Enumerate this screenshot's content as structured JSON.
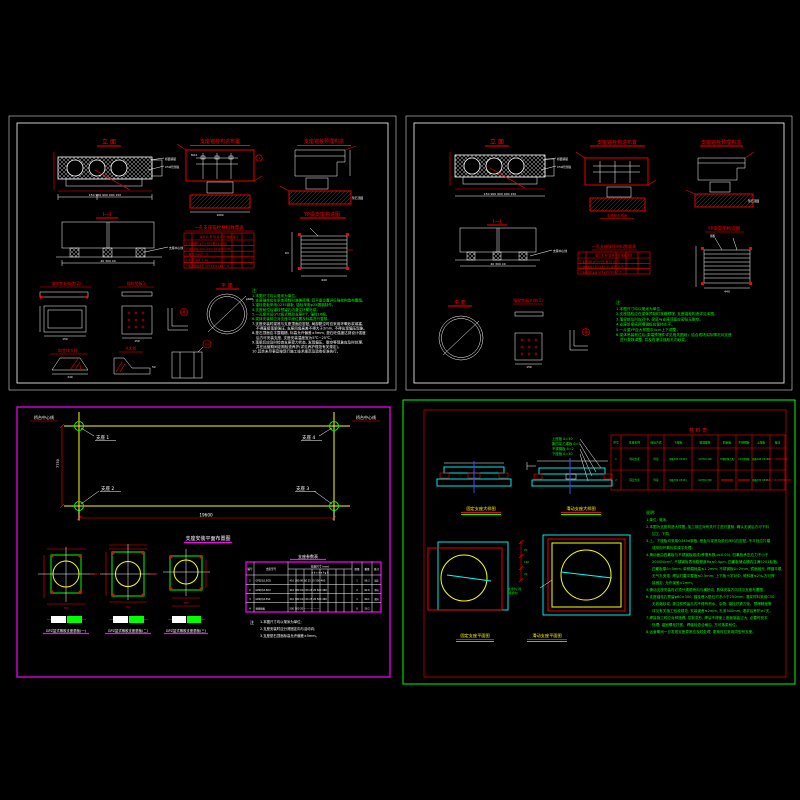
{
  "colors": {
    "background": "#000000",
    "line_white": "#ffffff",
    "line_red": "#ff0000",
    "line_green": "#00ff00",
    "line_yellow": "#ffff00",
    "line_cyan": "#00ffff",
    "line_magenta": "#ff00ff",
    "line_blue": "#4444ff"
  },
  "panel1": {
    "title_elevation": "立 面",
    "title_section": "Ⅰ—Ⅰ",
    "title_anchor_left": "支座锚栓构造布置",
    "title_anchor_right": "支座锚栓预埋构造",
    "title_yp": "YP梁支座构造图",
    "title_plan": "平 面",
    "title_pad2": "锚栓垫板构造(2)",
    "title_pad1": "锚栓垫板1",
    "title_wedge": "斜垫块大样",
    "title_detail_a": "A大样",
    "label_deck": "桥面铺装",
    "label_c50": "C50砼封锚",
    "label_center": "支座中心线",
    "label_m24": "M24",
    "label_phi600": "φ600",
    "label_phi60": "60",
    "label_mark1": "1",
    "dims": {
      "elevation": "150 900 900 900 150",
      "section": "40 300 40",
      "yp_w": "440",
      "yp_h": "63",
      "pad2": "150",
      "pad1": "150",
      "wedge": "240",
      "detail_a": "50",
      "anchor_base": "1000",
      "pedestal_top": "垫石顶面"
    },
    "table": {
      "title": "一孔支座锚栓材料数量表",
      "headers": [
        "编号",
        "名 称",
        "规 格",
        "单位",
        "数量",
        "备注"
      ],
      "rows": [
        [
          "1",
          "支座锚栓",
          "φ25×400",
          "根",
          "16",
          "Q235"
        ],
        [
          "2",
          "锚栓垫板",
          "150×150×10",
          "块",
          "8",
          "Q235"
        ],
        [
          "3",
          "螺 母",
          "M24",
          "个",
          "32",
          ""
        ],
        [
          "4",
          "垫 圈",
          "φ25",
          "个",
          "16",
          ""
        ],
        [
          "5",
          "板式橡胶支座",
          "GYZ φ250×63",
          "个",
          "8",
          ""
        ]
      ]
    },
    "notes_label": "注:",
    "notes_green": [
      "1.本图尺寸均以毫米为单位。",
      "2.支座锚栓应在梁体预制时准确预埋, 其平面位置详见锚栓构造布置图。",
      "3.锚栓垫板采用Q235钢板, 锚栓采用φ25圆钢制作。",
      "4.支座就位后锚栓预留孔内灌注环氧砂浆。",
      "5.一孔梁共设GYZ板式橡胶支座8个, 锚栓16根。",
      "6.梁体安装前应对支座平面位置及标高进行复核。"
    ],
    "notes_white": [
      "7.支座安装时梁底与支座顶面应密贴, 局部脱空时应采用环氧砂浆填塞,",
      "不得直接落梁强压, 支座四角高差不得大于2mm, 不得出现偏压现象。",
      "8.垫石顶面应平整粗糙, 标高允许偏差±5mm, 垫石砼强度达到设计强度",
      "后方可安装支座, 支座安装温度宜为5℃~25℃。",
      "9.落梁后应及时检查支座受力状态, 发现偏压、脱空等现象应及时处理,",
      "并在运营期间定期检查养护(详见养护规范有关规定)。",
      "10.其余未尽事宜按现行施工技术规范及验收标准执行。"
    ]
  },
  "panel2": {
    "title_elevation": "立 面",
    "title_section": "Ⅰ—Ⅰ",
    "title_anchor_left": "支座锚栓构造布置",
    "title_anchor_right": "支座锚栓预埋构造",
    "title_pedestal": "支座垫石构造",
    "title_yp": "YP梁支座构造图",
    "title_plan": "平 面",
    "title_pad1": "锚栓垫板大样(1)",
    "label_deck": "桥面铺装",
    "label_c50": "C50砼封锚",
    "label_center": "支座中心线",
    "label_pedestal_top": "垫石顶面",
    "label_steel": "钢板",
    "dims": {
      "elevation": "150 900 900 900 150",
      "section": "40 300 40",
      "yp_w": "440",
      "pad1": "150"
    },
    "table": {
      "title": "一孔支座锚栓材料数量表",
      "headers": [
        "编号",
        "名 称",
        "规 格",
        "单位",
        "数量",
        "备注"
      ],
      "rows": [
        [
          "1",
          "支座锚栓",
          "φ25×400",
          "根",
          "16",
          "Q235"
        ],
        [
          "2",
          "锚栓垫板",
          "150×150×10",
          "块",
          "8",
          "Q235"
        ],
        [
          "3",
          "板式橡胶支座",
          "GYZ φ250×63",
          "个",
          "8",
          ""
        ]
      ]
    },
    "notes_label": "注:",
    "notes_green": [
      "1.本图尺寸均以毫米为单位。",
      "2.支座锚栓应在梁体预制时准确预埋, 支座锚栓构造详见本图。",
      "3.落梁就位时应对中, 梁底与支座顶面应密贴无脱空。",
      "4.支座处梁底预埋钢板应保持水平。",
      "5.一片梁YP自大样图中4cm上下调整。",
      "6.梁体吊装就位后(梁端预埋件详见相关图纸), 结合现场实际情况对支座",
      "进行复核调整, 并及时灌注锚栓孔内砂浆。"
    ]
  },
  "panel3": {
    "label_top_left": "桥台中心线",
    "label_top_right": "桥台中心线",
    "bearing_labels": [
      "支座 1",
      "支座 2",
      "支座 3",
      "支座 4"
    ],
    "dim_span": "19600",
    "dim_width": "7750",
    "title": "支座安装平面布置图",
    "detail_labels": [
      "GPZ盆式橡胶支座垫板(一)",
      "GPZ盆式橡胶支座垫板(二)",
      "GPZ盆式橡胶支座垫板(三)"
    ],
    "detail_dims": [
      "700",
      "700",
      "580"
    ],
    "table": {
      "title": "支座参数表",
      "header_group": "支座尺寸(mm)",
      "col_no": "编号",
      "col_name": "支座型号",
      "sub_headers": "a  b  c  d  e  f  g  h",
      "col_qty": "数量",
      "col_weight": "重量",
      "col_remark": "备注",
      "rows": [
        {
          "no": "1",
          "name": "GPZ(Ⅱ)2.5GD",
          "dims": "410 380 90 60 25 20 500 460",
          "qty": "1",
          "weight": "86.3",
          "remark": "固定"
        },
        {
          "no": "2",
          "name": "GPZ(Ⅱ)2.5DX",
          "dims": "410 380 102 60 25 20 500 460",
          "qty": "2",
          "weight": "92.6",
          "remark": "单向"
        },
        {
          "no": "3",
          "name": "GPZ(Ⅱ)2.5SX",
          "dims": "410 380 102 60 25 20 500 460",
          "qty": "1",
          "weight": "90.1",
          "remark": "双向"
        },
        {
          "no": "4",
          "name": "预埋钢板",
          "dims": "500 500 20 — — — — —",
          "qty": "8",
          "weight": "39.2",
          "remark": ""
        }
      ]
    },
    "notes": [
      "注",
      "1.本图尺寸均以毫米为单位;",
      "2.支座安装时应分清固定向与活动向;",
      "3.支座垫石顶面标高允许偏差±5mm。"
    ]
  },
  "panel4": {
    "table": {
      "title": "材 料 表",
      "headers": [
        "序号",
        "支座名称",
        "连接方式",
        "下座板",
        "锚固螺栓",
        "四氟板",
        "不锈钢板",
        "上座板",
        "备注"
      ],
      "rows": [
        [
          "1",
          "滑动支座",
          "焊接",
          "钢板δ30 Q345d",
          "4-M30×300",
          "δ5聚四氟乙烯",
          "δ2不锈钢板",
          "钢板δ40 Q345d",
          "每孔2个,滑动面涂硅脂"
        ],
        [
          "2",
          "固定支座",
          "焊接",
          "钢板δ30 Q345d",
          "4-M30×300",
          "—",
          "—",
          "钢板δ30 Q345d",
          "每孔2个,与梁底预埋钢板焊接"
        ]
      ]
    },
    "legend": [
      "上座板 δ=30",
      "聚四氟乙烯板 δ=5",
      "不锈钢板 δ=2",
      "下座板 δ=30"
    ],
    "title_fixed_detail": "固定支座大样图",
    "title_sliding_detail": "滑动支座大样图",
    "title_fixed_plan": "固定支座平面图",
    "title_sliding_plan": "滑动支座平面图",
    "slide_dims": [
      "70",
      "190",
      "70"
    ],
    "center_note_1": "支座中心线",
    "center_note_2": "(顺桥向)",
    "notes": [
      "说明:",
      "1.单位: 毫米。",
      "2.本图为支座构造大样图, 加工前应对有关尺寸进行复核, 确认无误后方可下料",
      "加工, 下同。",
      "3.上、下座板均采用Q345d钢板, 座板与梁底及垫石间均应密贴, 不平处应打磨",
      "或采用环氧砂浆调平处理。",
      "4.滑动面由四氟板与不锈钢板组成(摩擦系数μ≤0.03), 四氟板承压应力不小于",
      "2000N/cm², 不锈钢板表面粗糙度Ra≤0.4μm, 四氟板储油槽内注满5201硅脂。",
      "四氟板厚δ=5mm, 单侧磨耗量≤1.2mm; 不锈钢板δ=2mm, 镜面抛光, 焊缝平顺,",
      "无气孔夹渣, 焊后打磨平整度≤0.5mm; 上下板十字对中, 倾斜度≤2‰方可焊",
      "接固定, 允许误差±2mm。",
      "5.滑动支座安装时必须分清顺桥向与横桥向, 具体安装方向详见支座布置图。",
      "6.支座锚栓孔预留φ60×300, 锚栓埋入垫石内不小于250mm, 灌浆材料采用C50",
      "无收缩砂浆, 灌注前预留孔内不得有积水、杂物, 锚栓拧紧力矩、预埋精度等",
      "详见有关施工验收规范, 安装误差≤2mm, 孔深300mm, 灌浆后养护≥7天。",
      "7.焊接施工时应对称施焊, 控制变形, 焊后不得使上座板翘曲过大, 必要时校平",
      "处理; 锚固螺栓拧紧、焊缝检查合格后, 方可落梁就位。",
      "8.运营期间一旦发现支座异常应及时处理, 更换时应采用同型号支座。"
    ]
  }
}
